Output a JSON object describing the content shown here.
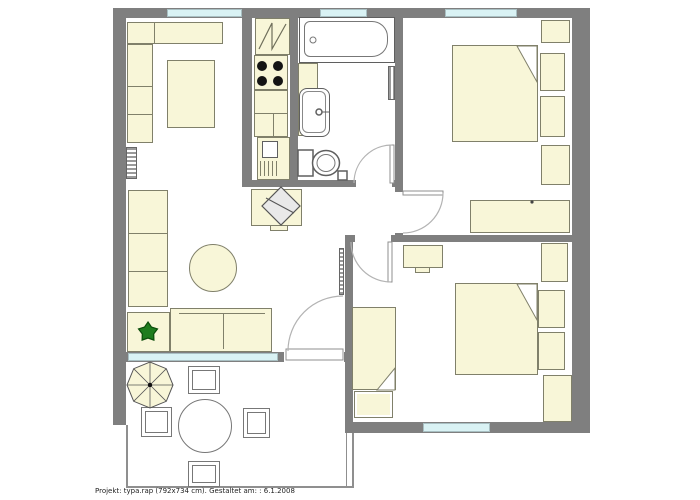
{
  "footer": {
    "text": "Projekt: typa.rap (792x734 cm). Gestaltet am: : 6.1.2008"
  },
  "colors": {
    "wall": "#7f7f7f",
    "window": "#d9f2f4",
    "furniture": "#f8f6d8",
    "furniture_border": "#80806a",
    "fixture_border": "#5f5f5f",
    "arc": "#b3b3b3",
    "plant": "#1e7c1e",
    "burner": "#141414",
    "text": "#222222"
  }
}
